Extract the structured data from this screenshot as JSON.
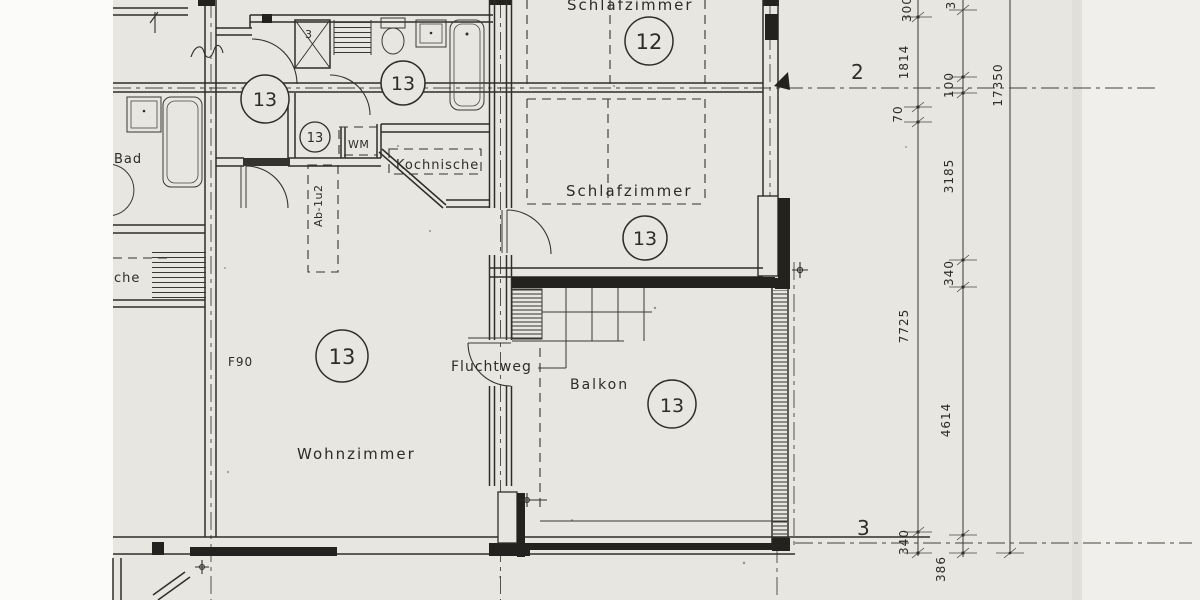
{
  "document": {
    "type": "scanned-floor-plan",
    "colors": {
      "paper": "#e8e6e1",
      "paper_white": "#fbfbf9",
      "ink": "#2f2d28",
      "black_wall": "#23221e"
    }
  },
  "rooms": {
    "schlafzimmer_top": {
      "label": "Schlafzimmer",
      "unit_number": "12"
    },
    "schlafzimmer": {
      "label": "Schlafzimmer",
      "unit_number": "13"
    },
    "wohnzimmer": {
      "label": "Wohnzimmer",
      "unit_number": "13"
    },
    "balkon": {
      "label": "Balkon",
      "unit_number": "13"
    },
    "bad": {
      "label": "Bad"
    },
    "kueche": {
      "label_partial": "che"
    },
    "kochnische": {
      "label": "Kochnische"
    }
  },
  "unit_circles": {
    "hall": "13",
    "bath": "13",
    "wc": "13"
  },
  "annotations": {
    "wm": "WM",
    "ab_shaft": "Ab-1u2",
    "f90": "F90",
    "fluchtweg": "Fluchtweg",
    "shaft_number": "3"
  },
  "sections": {
    "marker_top": "2",
    "marker_bottom": "3"
  },
  "dimensions": {
    "chain_inner": [
      "300",
      "1814",
      "70",
      "7725",
      "340"
    ],
    "chain_outer": [
      "3",
      "100",
      "3185",
      "340",
      "4614",
      "386"
    ],
    "overall": "17350"
  }
}
